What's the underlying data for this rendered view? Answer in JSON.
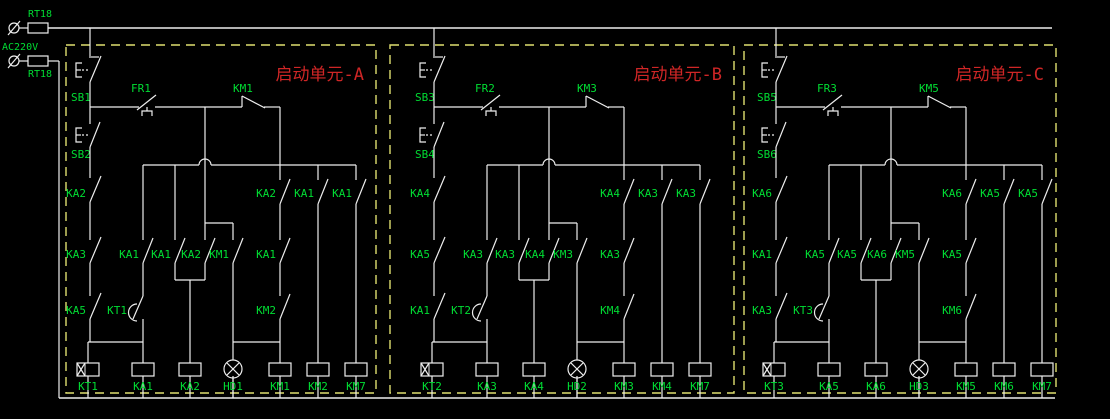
{
  "colors": {
    "background": "#000000",
    "wire": "#eeeeee",
    "label": "#00dd33",
    "title": "#cf2626",
    "frame": "#dfdf70"
  },
  "power": {
    "fuse_top_label": "RT18",
    "fuse_bottom_label": "RT18",
    "voltage_label": "AC220V"
  },
  "units": [
    {
      "title": "启动单元-A",
      "stop_button": "SB1",
      "start_button": "SB2",
      "thermal_relay": "FR1",
      "contactor_contact": "KM1",
      "rail_row1": "KA2",
      "rail_row2": "KA3",
      "rail_row3": "KA5",
      "col2_row2": "KA1",
      "timer_contact": "KT1",
      "col3_row2": "KA1",
      "col4_row2": "KA2",
      "col5_row2": "KM1",
      "branch_row1": [
        "KA2",
        "KA1",
        "KA1"
      ],
      "branch_row2": "KA1",
      "branch_row3": "KM2",
      "coils": [
        "KT1",
        "KA1",
        "KA2",
        "HD1",
        "KM1",
        "KM2",
        "KM7"
      ]
    },
    {
      "title": "启动单元-B",
      "stop_button": "SB3",
      "start_button": "SB4",
      "thermal_relay": "FR2",
      "contactor_contact": "KM3",
      "rail_row1": "KA4",
      "rail_row2": "KA5",
      "rail_row3": "KA1",
      "col2_row2": "KA3",
      "timer_contact": "KT2",
      "col3_row2": "KA3",
      "col4_row2": "KA4",
      "col5_row2": "KM3",
      "branch_row1": [
        "KA4",
        "KA3",
        "KA3"
      ],
      "branch_row2": "KA3",
      "branch_row3": "KM4",
      "coils": [
        "KT2",
        "KA3",
        "KA4",
        "HD2",
        "KM3",
        "KM4",
        "KM7"
      ]
    },
    {
      "title": "启动单元-C",
      "stop_button": "SB5",
      "start_button": "SB6",
      "thermal_relay": "FR3",
      "contactor_contact": "KM5",
      "rail_row1": "KA6",
      "rail_row2": "KA1",
      "rail_row3": "KA3",
      "col2_row2": "KA5",
      "timer_contact": "KT3",
      "col3_row2": "KA5",
      "col4_row2": "KA6",
      "col5_row2": "KM5",
      "branch_row1": [
        "KA6",
        "KA5",
        "KA5"
      ],
      "branch_row2": "KA5",
      "branch_row3": "KM6",
      "coils": [
        "KT3",
        "KA5",
        "KA6",
        "HD3",
        "KM5",
        "KM6",
        "KM7"
      ]
    }
  ]
}
